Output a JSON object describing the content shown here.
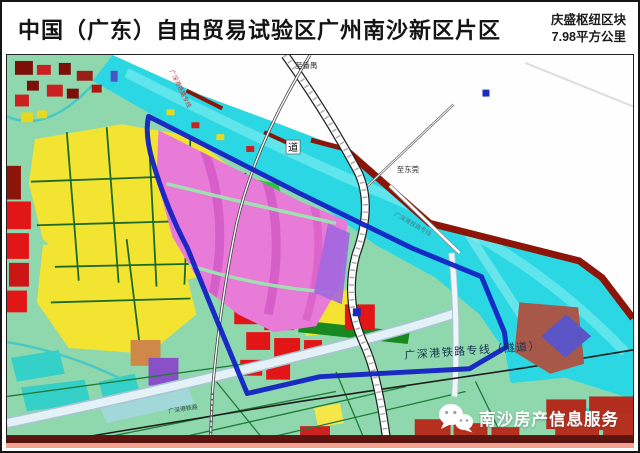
{
  "header": {
    "title": "中国（广东）自由贸易试验区广州南沙新区片区",
    "block_name": "庆盛枢纽区块",
    "block_area": "7.98平方公里"
  },
  "map": {
    "label_to_panyu": "至番禺",
    "label_to_dongguan": "至东莞",
    "label_river_char": "道",
    "label_rail_tunnel": "广深港铁路专线（隧道）",
    "label_rail_top": "广深港铁路专线",
    "label_rail_water": "广深港铁路专线",
    "label_rail_bottom": "广深港铁路"
  },
  "watermark": {
    "text": "南沙房产信息服务",
    "icon": "wechat-icon"
  },
  "colors": {
    "boundary_blue": "#1322c4",
    "river_cyan": "#2ad7e2",
    "zone_magenta": "#e87ad8",
    "parcel_yellow": "#f2e430",
    "parcel_red": "#e21617",
    "embankment_maroon": "#8b1508",
    "land_green": "#8fd8ae",
    "pond_teal": "#35d0c8",
    "watermark_white": "#ffffff"
  }
}
